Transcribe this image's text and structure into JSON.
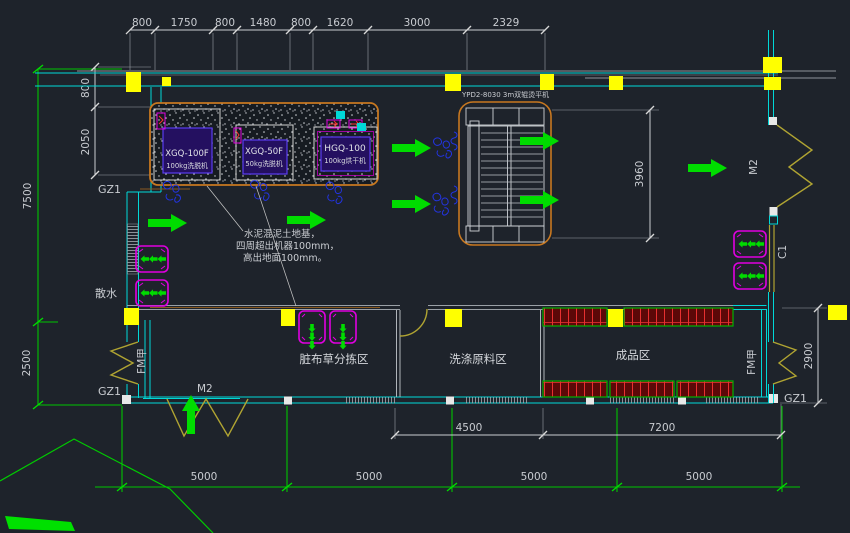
{
  "canvas": {
    "background": "#1e232b"
  },
  "palette": {
    "wall_cyan": "#00d8d8",
    "axis_green": "#00c400",
    "arrow_green": "#00dc00",
    "column_yellow": "#ffff00",
    "door_olive": "#b0a432",
    "trolley_magenta": "#e000e0",
    "machine_purple": "#5a3cf0",
    "pad_orange": "#c87820",
    "shelf_red": "#e83030",
    "shelf_border_green": "#00b400",
    "drain_blue": "#2334e0",
    "dim_text": "#c9ccd1"
  },
  "dims": {
    "top": [
      "800",
      "1750",
      "800",
      "1480",
      "800",
      "1620",
      "3000",
      "2329"
    ],
    "left_wall": [
      "800",
      "2050"
    ],
    "left_axis": [
      "7500",
      "2500"
    ],
    "ironer_height": "3960",
    "right_door": "2900",
    "bottom_inner": [
      "4500",
      "7200"
    ],
    "bottom_axis": [
      "5000",
      "5000",
      "5000",
      "5000"
    ]
  },
  "labels": {
    "gz1": "GZ1",
    "m2": "M2",
    "c1": "C1",
    "fm_door": "FM甲",
    "splash_apron": "散水"
  },
  "machines": [
    {
      "model": "XGQ-100F",
      "spec": "100kg洗脱机"
    },
    {
      "model": "XGQ-50F",
      "spec": "50kg洗脱机"
    },
    {
      "model": "HGQ-100",
      "spec": "100kg烘干机"
    }
  ],
  "ironer": {
    "label": "YPD2-8030  3m双辊烫平机"
  },
  "foundation_note": {
    "line1": "水泥混泥土地基，",
    "line2": "四周超出机器100mm，",
    "line3": "高出地面100mm。"
  },
  "rooms": {
    "sorting": "脏布草分拣区",
    "raw_material": "洗涤原料区",
    "finished": "成品区"
  }
}
